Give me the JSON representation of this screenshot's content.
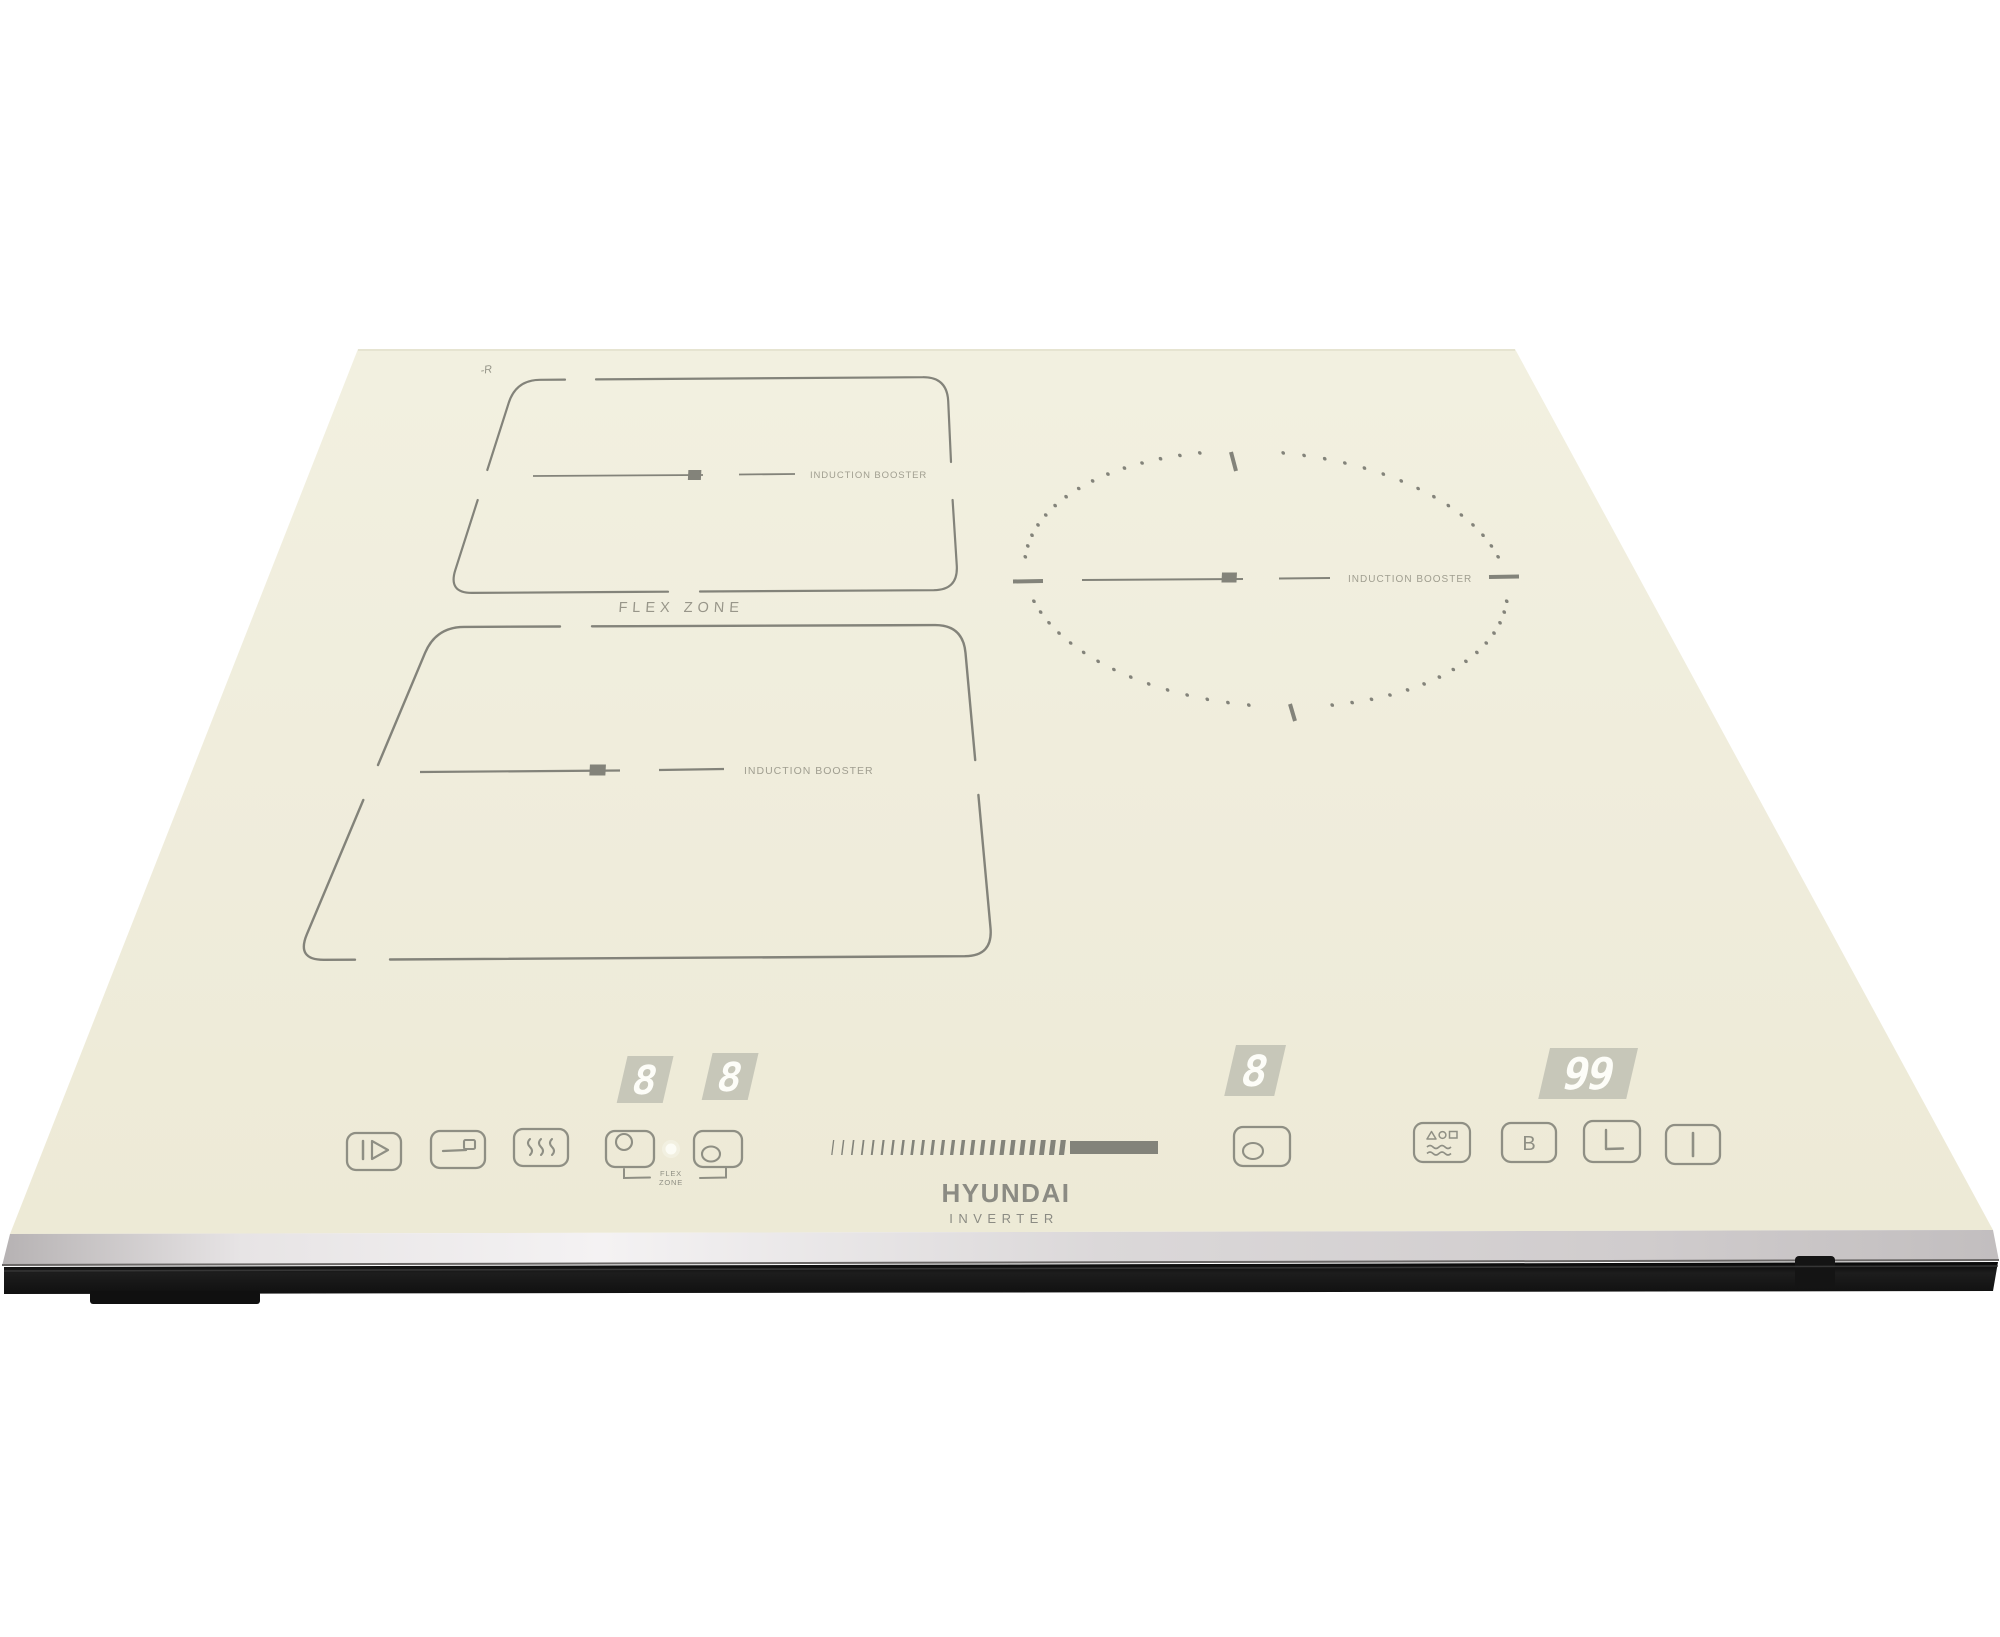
{
  "brand": {
    "name": "HYUNDAI",
    "sub": "INVERTER",
    "glass_mark": "-R"
  },
  "labels": {
    "flex_zone": "FLEX ZONE",
    "booster_rear": "INDUCTION BOOSTER",
    "booster_front": "INDUCTION BOOSTER",
    "booster_right": "INDUCTION BOOSTER",
    "flex_badge_line1": "FLEX",
    "flex_badge_line2": "ZONE"
  },
  "displays": {
    "rear_level": "8",
    "front_level": "8",
    "right_level": "8",
    "timer": "99"
  },
  "buttons": {
    "pause": {
      "icon": "pause-icon"
    },
    "bridge": {
      "icon": "bridge-icon"
    },
    "keep_warm": {
      "icon": "keep-warm-icon"
    },
    "rear_zone_select": {
      "icon": "rear-zone-icon"
    },
    "front_zone_select": {
      "icon": "front-zone-icon"
    },
    "right_zone_select": {
      "icon": "single-zone-icon"
    },
    "auto_menu": {
      "icon": "auto-menu-icon"
    },
    "booster": {
      "label": "B"
    },
    "timer": {
      "icon": "clock-icon"
    },
    "power": {
      "icon": "power-icon"
    }
  },
  "slider": {
    "tick_count": 24,
    "has_filled_bar": true
  },
  "circle_zone": {
    "dot_count": 72
  },
  "colors": {
    "glass": "#f0eedd",
    "print": "#83837a",
    "label": "#a09e90",
    "display_bg": "#c7c7b9",
    "digit": "#fdfdf8",
    "edge": "#d6d2d3",
    "base": "#161616"
  }
}
